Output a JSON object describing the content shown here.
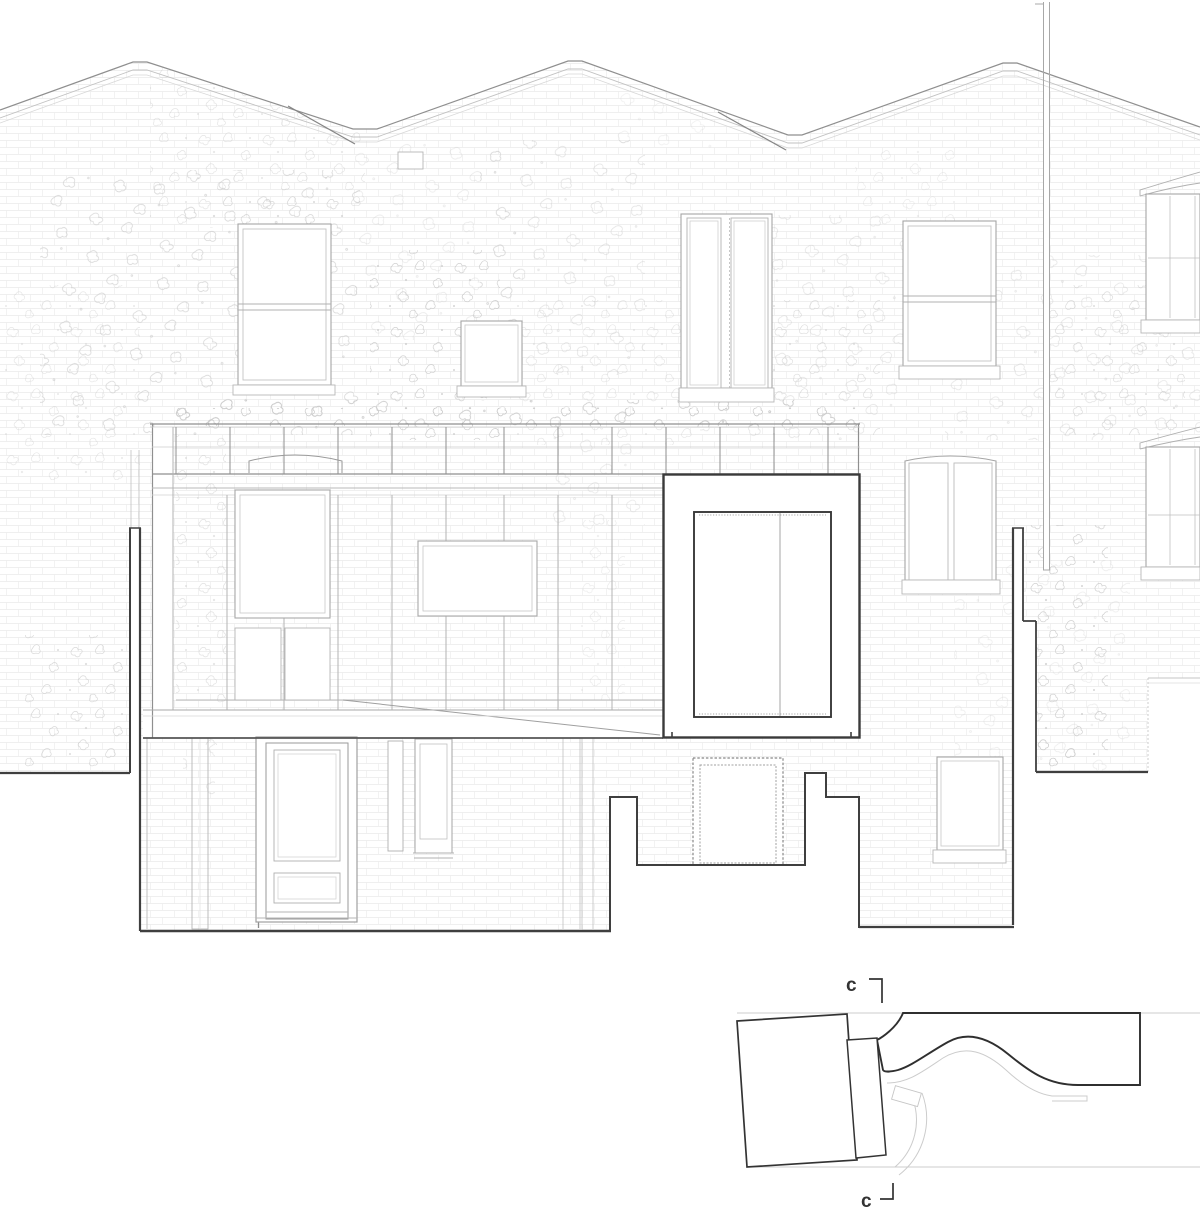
{
  "drawing": {
    "type": "architectural rear elevation with plan detail",
    "section_markers": [
      {
        "label": "c"
      },
      {
        "label": "c"
      }
    ],
    "colors": {
      "background": "#ffffff",
      "line_bold": "#3f3f3f",
      "line_detail": "#2f2f2f",
      "line_medium": "#9a9a9a",
      "line_light": "#c6c6c6",
      "brick": "#e6e6e6",
      "label": "#333333"
    }
  }
}
